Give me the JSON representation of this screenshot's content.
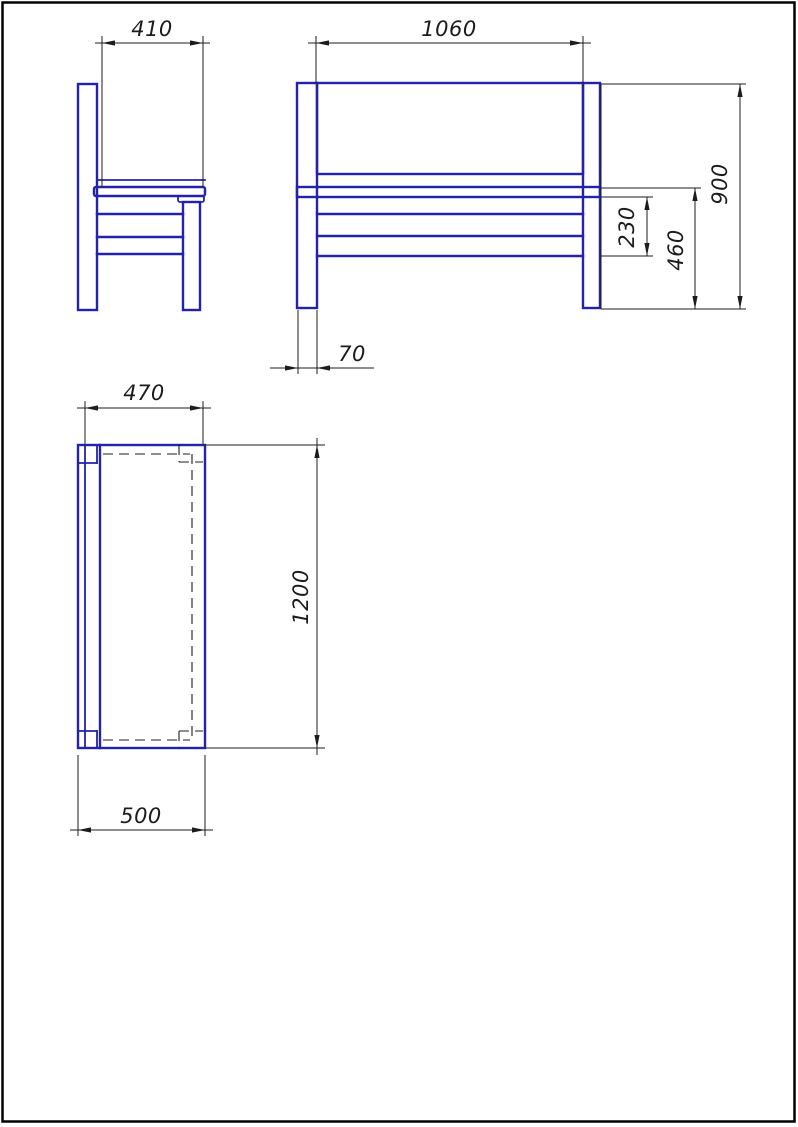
{
  "page": {
    "background": "#ffffff",
    "border_color": "#000000"
  },
  "linework": {
    "object_color": "#2222aa",
    "dimension_color": "#1c1c1c",
    "hidden_line_style": "dashed"
  },
  "views": {
    "side": {
      "dim_seat_depth": "410"
    },
    "front": {
      "dim_backrest_span": "1060",
      "dim_overall_height": "900",
      "dim_seat_height": "460",
      "dim_rail_band_height": "230",
      "dim_leg_width": "70"
    },
    "top": {
      "dim_seat_width": "470",
      "dim_length": "1200",
      "dim_overall_depth": "500"
    }
  }
}
